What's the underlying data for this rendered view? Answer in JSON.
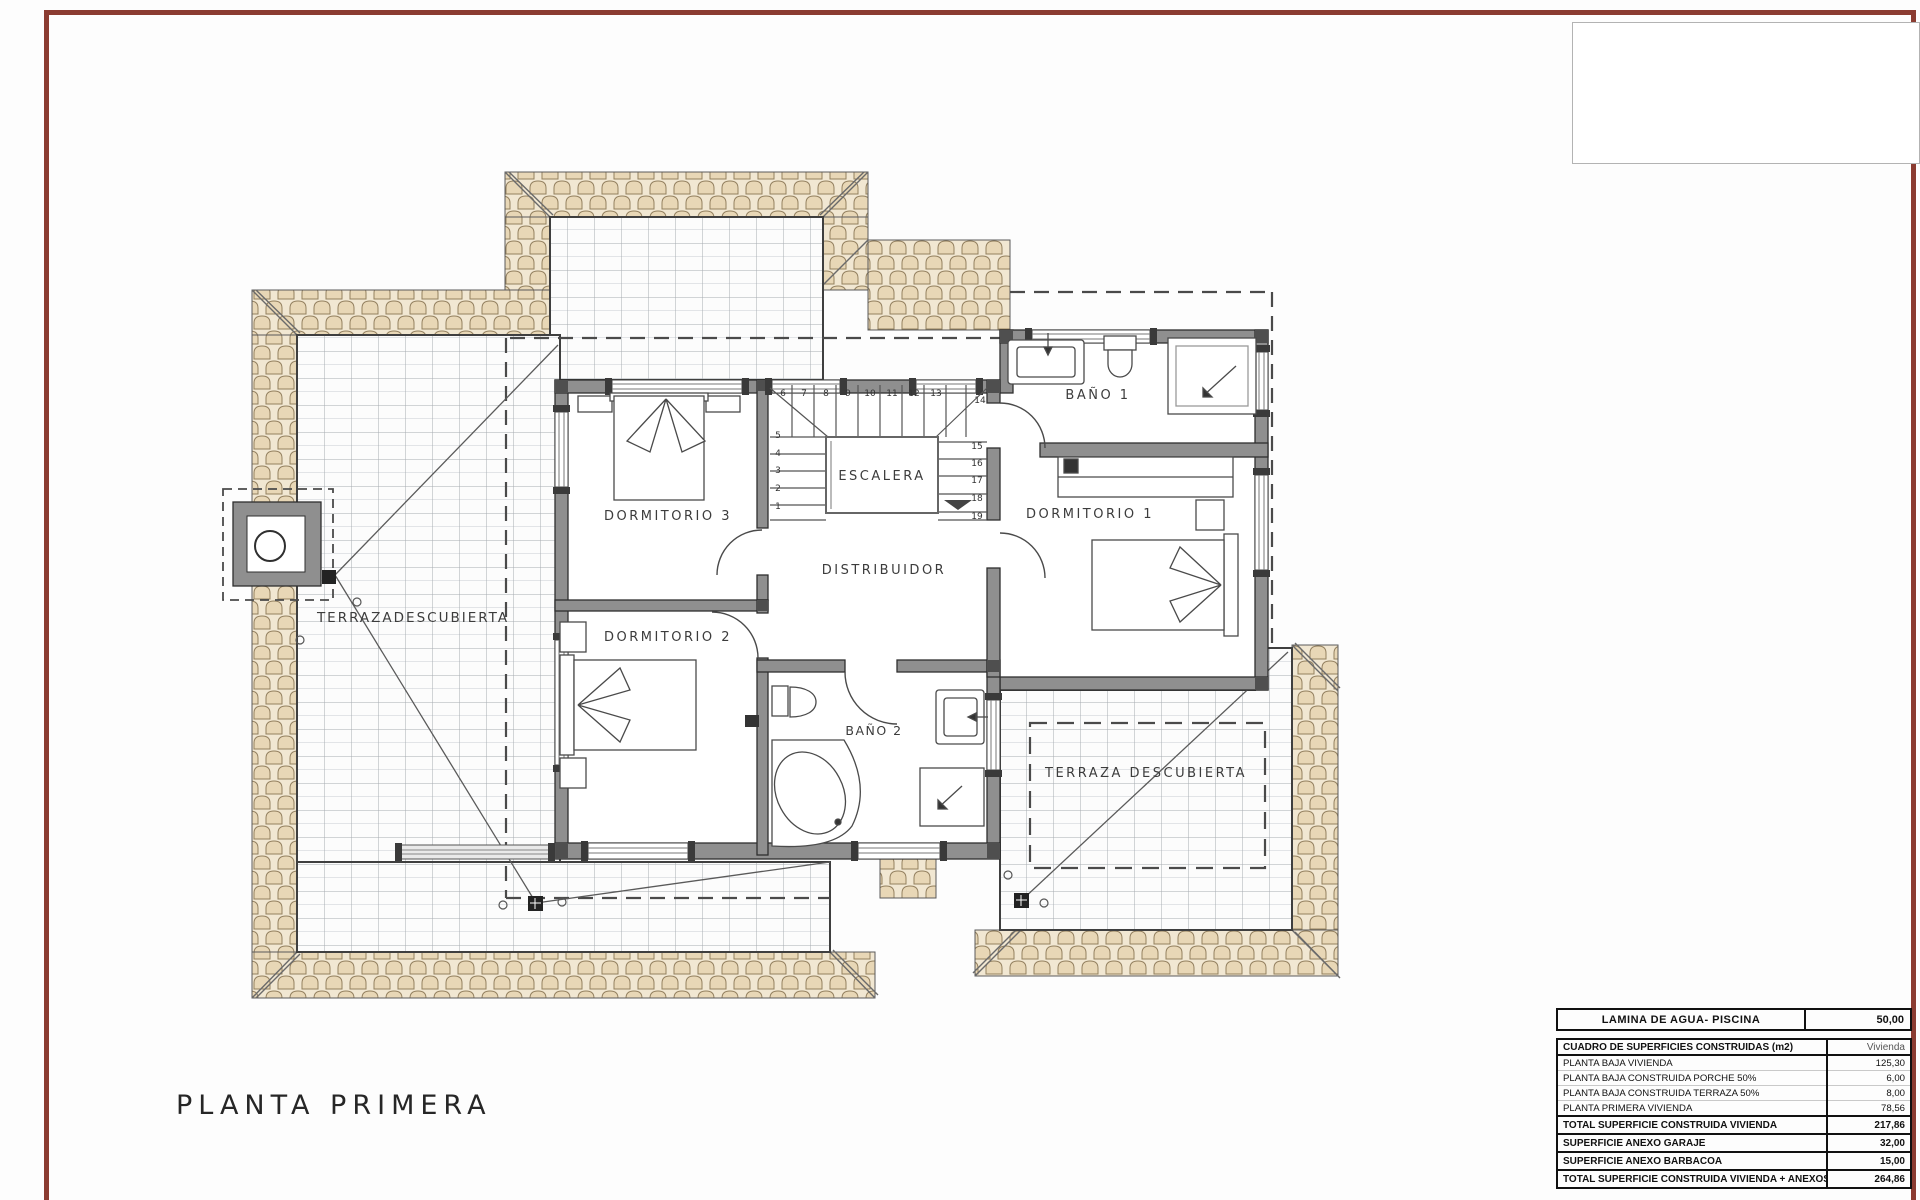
{
  "sheet": {
    "frame_color": "#8b3c31",
    "plan_title": "PLANTA PRIMERA"
  },
  "plan": {
    "rooms": {
      "dormitorio1": "DORMITORIO 1",
      "dormitorio2": "DORMITORIO 2",
      "dormitorio3": "DORMITORIO 3",
      "bano1": "BAÑO 1",
      "bano2": "BAÑO 2",
      "escalera": "ESCALERA",
      "distribuidor": "DISTRIBUIDOR",
      "terraza_izquierda": "TERRAZADESCUBIERTA",
      "terraza_derecha": "TERRAZA DESCUBIERTA"
    },
    "stair_numbers": [
      "1",
      "2",
      "3",
      "4",
      "5",
      "6",
      "7",
      "8",
      "9",
      "10",
      "11",
      "12",
      "13",
      "14",
      "15",
      "16",
      "17",
      "18",
      "19"
    ],
    "colors": {
      "roof_tile": "#e8d7b6",
      "roof_tile_bg": "#f1e7d2",
      "wall_gray": "#8f8f8f",
      "grid_line": "#a6abb1"
    }
  },
  "tables": {
    "piscina": {
      "label": "LAMINA DE AGUA- PISCINA",
      "value": "50,00"
    },
    "surfaces": {
      "header": {
        "label": "CUADRO DE SUPERFICIES CONSTRUIDAS (m2)",
        "value": "Vivienda"
      },
      "rows": [
        {
          "label": "PLANTA BAJA VIVIENDA",
          "value": "125,30"
        },
        {
          "label": "PLANTA BAJA CONSTRUIDA PORCHE 50%",
          "value": "6,00"
        },
        {
          "label": "PLANTA BAJA CONSTRUIDA TERRAZA 50%",
          "value": "8,00"
        },
        {
          "label": "PLANTA PRIMERA VIVIENDA",
          "value": "78,56"
        }
      ],
      "totals": [
        {
          "label": "TOTAL SUPERFICIE CONSTRUIDA VIVIENDA",
          "value": "217,86"
        },
        {
          "label": "SUPERFICIE ANEXO GARAJE",
          "value": "32,00"
        },
        {
          "label": "SUPERFICIE ANEXO BARBACOA",
          "value": "15,00"
        },
        {
          "label": "TOTAL SUPERFICIE CONSTRUIDA VIVIENDA + ANEXOS",
          "value": "264,86"
        }
      ]
    }
  }
}
